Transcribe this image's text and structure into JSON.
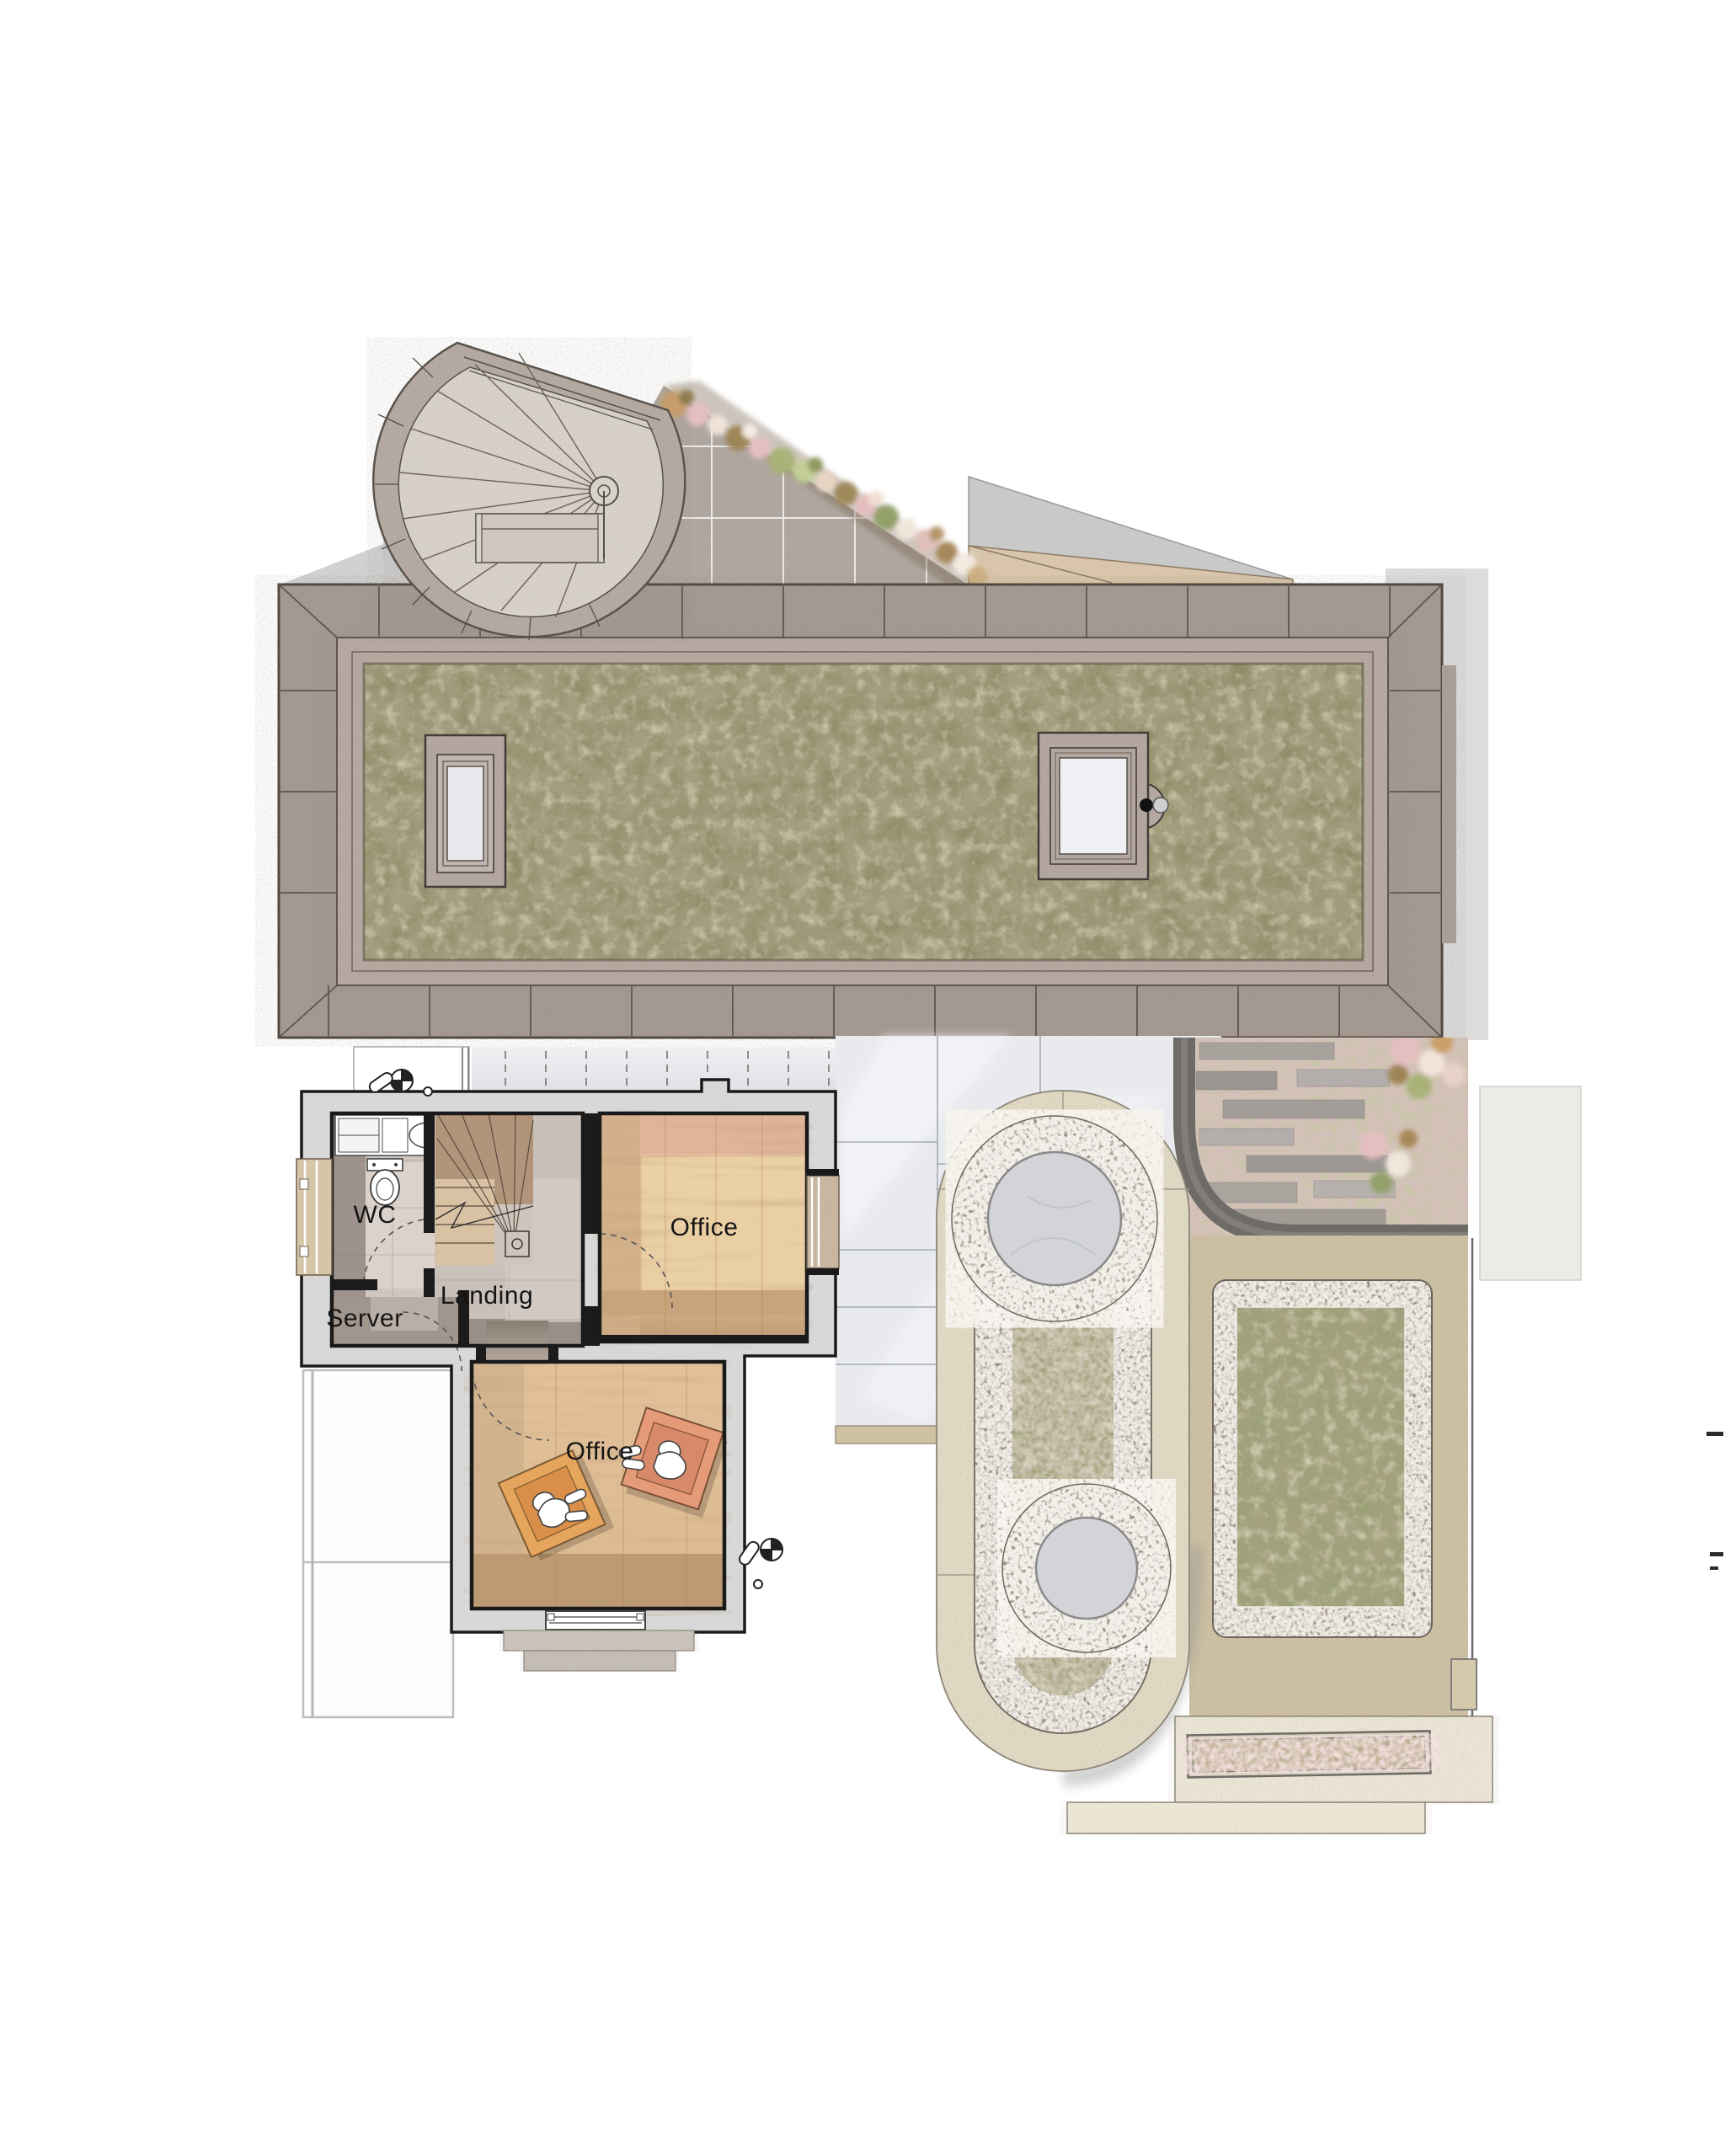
{
  "plan": {
    "rooms": [
      {
        "id": "wc",
        "label": "WC"
      },
      {
        "id": "landing",
        "label": "Landing"
      },
      {
        "id": "server",
        "label": "Server"
      },
      {
        "id": "office-upper",
        "label": "Office"
      },
      {
        "id": "office-lower",
        "label": "Office"
      }
    ]
  },
  "features": [
    "spiral-stair-tower",
    "sedum-green-roof",
    "roof-skylight-left",
    "roof-skylight-right",
    "roof-vent",
    "glazed-canopy",
    "east-terrace",
    "slope-garden-steps",
    "oval-planting-bed",
    "stone-circle-upper",
    "stone-circle-lower",
    "rectangular-planting-bed",
    "south-terrace",
    "planter-strip",
    "survey-level-marker"
  ],
  "palette": {
    "background": "#ffffff",
    "wall_gray": "#d8d8d8",
    "wall_line": "#1a1a1a",
    "roof_band": "#a59a92",
    "roof_inner_band": "#b8aaa3",
    "sedum_green": "#8f8a66",
    "tile_taupe": "#cfc6c0",
    "tile_dark": "#9e938c",
    "wood_light": "#e3c49c",
    "wood_dark": "#c09c74",
    "chair_accent": "#e6a55c",
    "chair_accent2": "#e59a78",
    "glass": "#eceef2",
    "cream_paving": "#e4ddc7",
    "pebble_band": "#b3a79d",
    "tan_paving": "#cfc2a4",
    "gravel_pink": "#d8c5bd",
    "stone_disc": "#d2d4d7",
    "terrace_pale": "#e8eaee"
  }
}
